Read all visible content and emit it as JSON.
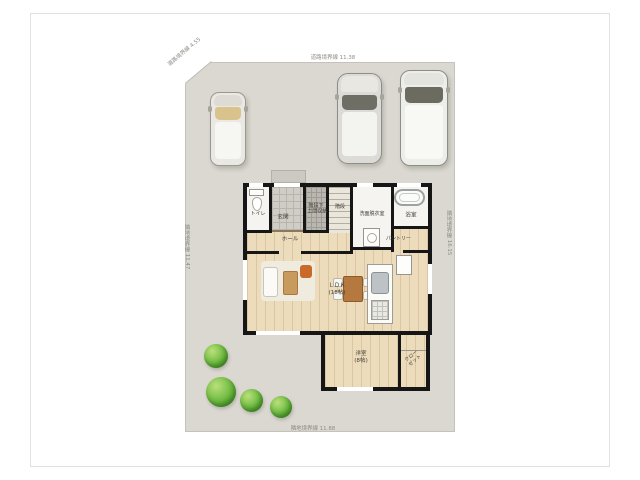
{
  "plan": {
    "boundaries": {
      "top": "道路境界線 11.38",
      "bottom": "隣地境界線 11.88",
      "left": "隣地境界線 11.47",
      "right": "隣地境界線 16.15",
      "corner": "道路境界線 4.55"
    },
    "rooms": {
      "toilet": "トイレ",
      "entrance": "玄関",
      "storage_line1": "階段下",
      "storage_line2": "土間収納",
      "stairs": "階段",
      "washroom": "洗面脱衣室",
      "bath": "浴室",
      "hall": "ホール",
      "pantry": "パントリー",
      "ldk": "ＬＤＫ",
      "ldk_size": "(18帖)",
      "bedroom": "洋室",
      "bedroom_size": "(8帖)",
      "closet_line1": "クロー",
      "closet_line2": "ゼット"
    },
    "objects": {
      "cars": [
        "compact-car",
        "suv",
        "minivan"
      ],
      "trees": 4,
      "furniture": [
        "sofa",
        "rug",
        "coffee-table",
        "accent-chair",
        "dining-table",
        "dining-chairs",
        "kitchen-counter",
        "sink",
        "stove",
        "refrigerator",
        "bathtub",
        "toilet-fixture",
        "washing-machine"
      ]
    },
    "colors": {
      "site": "#dad8d0",
      "wall": "#161616",
      "wood_floor": "#ecdcbb",
      "tile": "#cfcdc6",
      "tree_green": "#6cb93f",
      "accent_orange": "#c96a2a",
      "table_brown": "#b5783e"
    }
  }
}
